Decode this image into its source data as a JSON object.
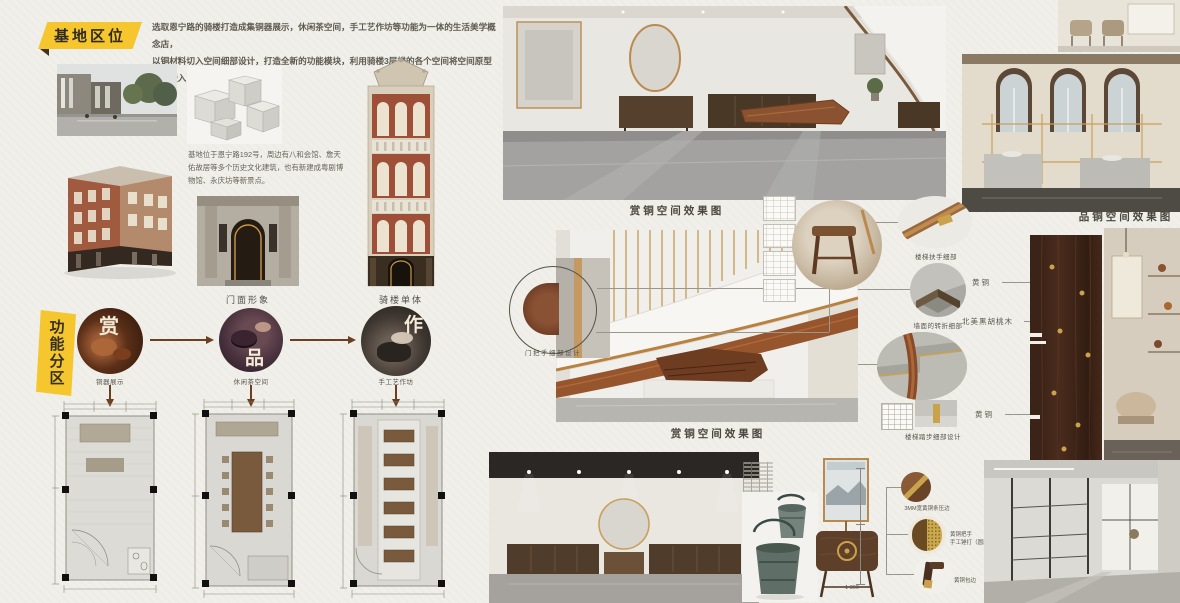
{
  "poster": {
    "section1_title": "基地区位",
    "intro": {
      "line1": "选取恩宁路的骑楼打造成集铜器展示，休闲茶空间，手工艺作坊等功能为一体的生活美学概念店，",
      "line2": "以铜材料切入空间细部设计，打造全新的功能模块，利用骑楼3层楼的各个空间将空间原型分别嵌入！"
    },
    "site_text": "基地位于恩宁路192号，周边有八和会馆、詹天佑故居等多个历史文化建筑，也有新建成粤剧博物馆、永庆坊等新景点。",
    "captions": {
      "facade": "门面形象",
      "building": "骑楼单体"
    },
    "zoning": {
      "title": "功能分区",
      "nodes": [
        {
          "char": "赏",
          "label": "铜器展示"
        },
        {
          "char": "品",
          "label": "休闲茶空间"
        },
        {
          "char": "作",
          "label": "手工艺作坊"
        }
      ]
    },
    "render_labels": {
      "shang_top": "赏铜空间效果图",
      "shang_mid": "赏铜空间效果图",
      "pin": "品铜空间效果图"
    },
    "details": {
      "door_handle": "门把手细部设计",
      "handrail": "楼梯扶手细部",
      "wall_corner": "墙面的转折细部",
      "stair_tread": "楼梯踏步细部设计",
      "brass_strip": "3MM宽黄铜条压边",
      "brass_handle_line1": "黄铜把手",
      "brass_handle_line2": "手工锤打（圆形镶嵌）",
      "brass_wrap": "黄铜包边"
    },
    "materials": {
      "brass_top": "黄铜",
      "walnut": "北美黑胡桃木",
      "brass_bottom": "黄铜"
    },
    "dims": {
      "dresser_width": "1 360"
    },
    "colors": {
      "accent_yellow": "#f6c62f",
      "copper": "#8a5230",
      "brass": "#c9a05a"
    }
  }
}
